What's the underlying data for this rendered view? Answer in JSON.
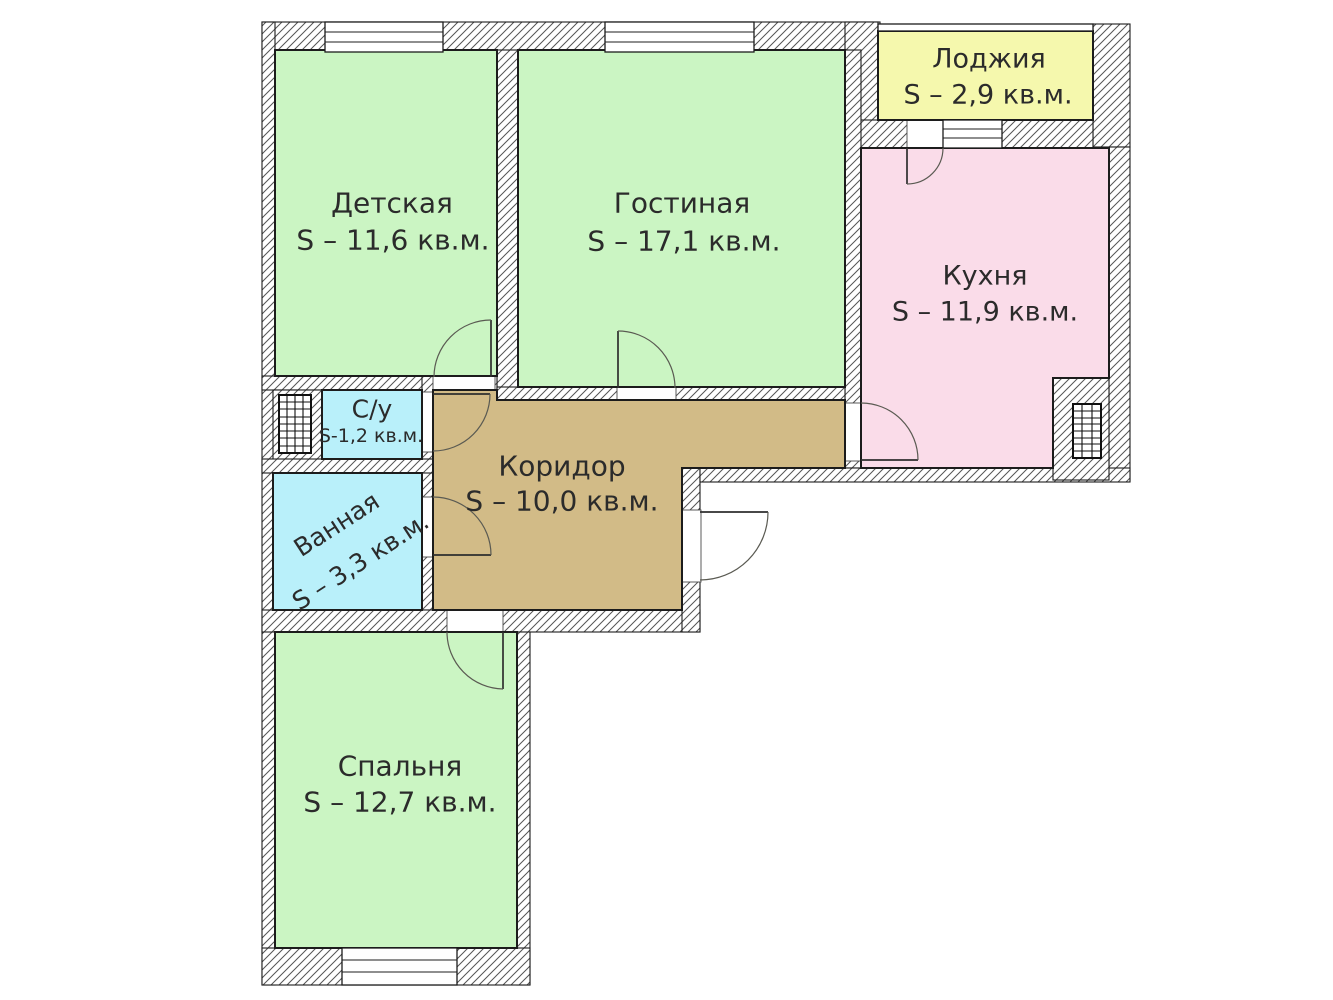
{
  "plan": {
    "rooms": {
      "detskaya": {
        "name": "Детская",
        "area": "S – 11,6 кв.м."
      },
      "gostinaya": {
        "name": "Гостиная",
        "area": "S – 17,1 кв.м."
      },
      "lodzhiya": {
        "name": "Лоджия",
        "area": "S – 2,9 кв.м."
      },
      "kuhnya": {
        "name": "Кухня",
        "area": "S – 11,9 кв.м."
      },
      "su": {
        "name": "С/у",
        "area": "S-1,2 кв.м."
      },
      "vannaya": {
        "name": "Ванная",
        "area": "S – 3,3 кв.м."
      },
      "koridor": {
        "name": "Коридор",
        "area": "S – 10,0 кв.м."
      },
      "spalnya": {
        "name": "Спальня",
        "area": "S – 12,7 кв.м."
      }
    },
    "colors": {
      "room_green": "#cbf5c3",
      "room_pink": "#fadce9",
      "room_yellow": "#f5f8ad",
      "room_cyan": "#b9f0fa",
      "room_brown": "#d2bb87",
      "wall_line": "#1c1c1c",
      "hatch_line": "#555555",
      "text": "#2b2b2b"
    }
  }
}
